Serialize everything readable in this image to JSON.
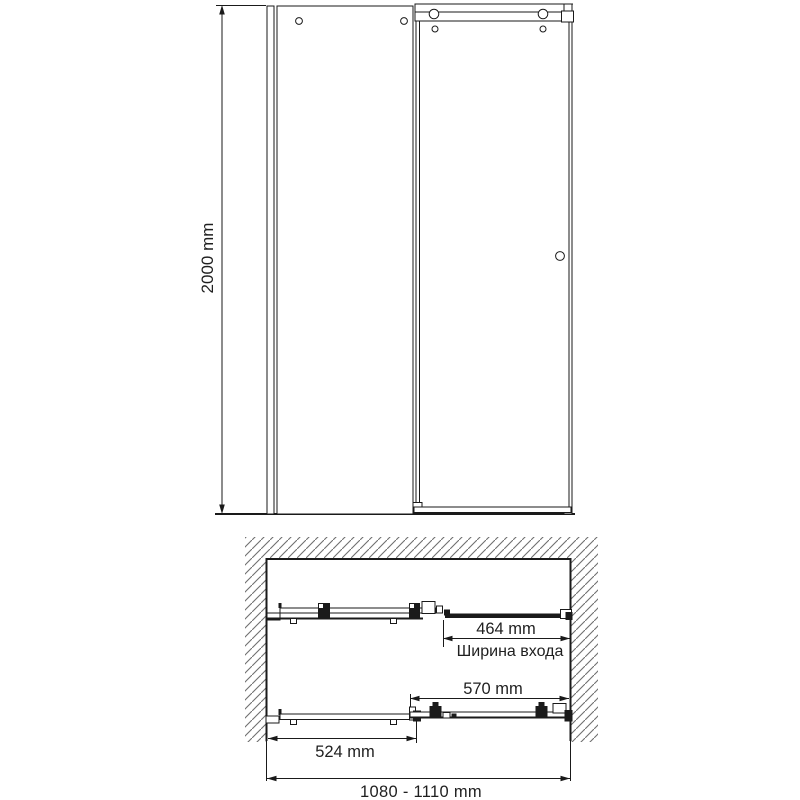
{
  "front_view": {
    "height": "2000 mm"
  },
  "plan_view": {
    "entrance_width": "464 mm",
    "entrance_caption": "Ширина входа",
    "door_panel_width": "570 mm",
    "fixed_panel_width": "524 mm",
    "overall_width": "1080 - 1110 mm"
  },
  "colors": {
    "line": "#1a1a1a",
    "hatch": "#6f6f6f",
    "background": "#ffffff"
  }
}
